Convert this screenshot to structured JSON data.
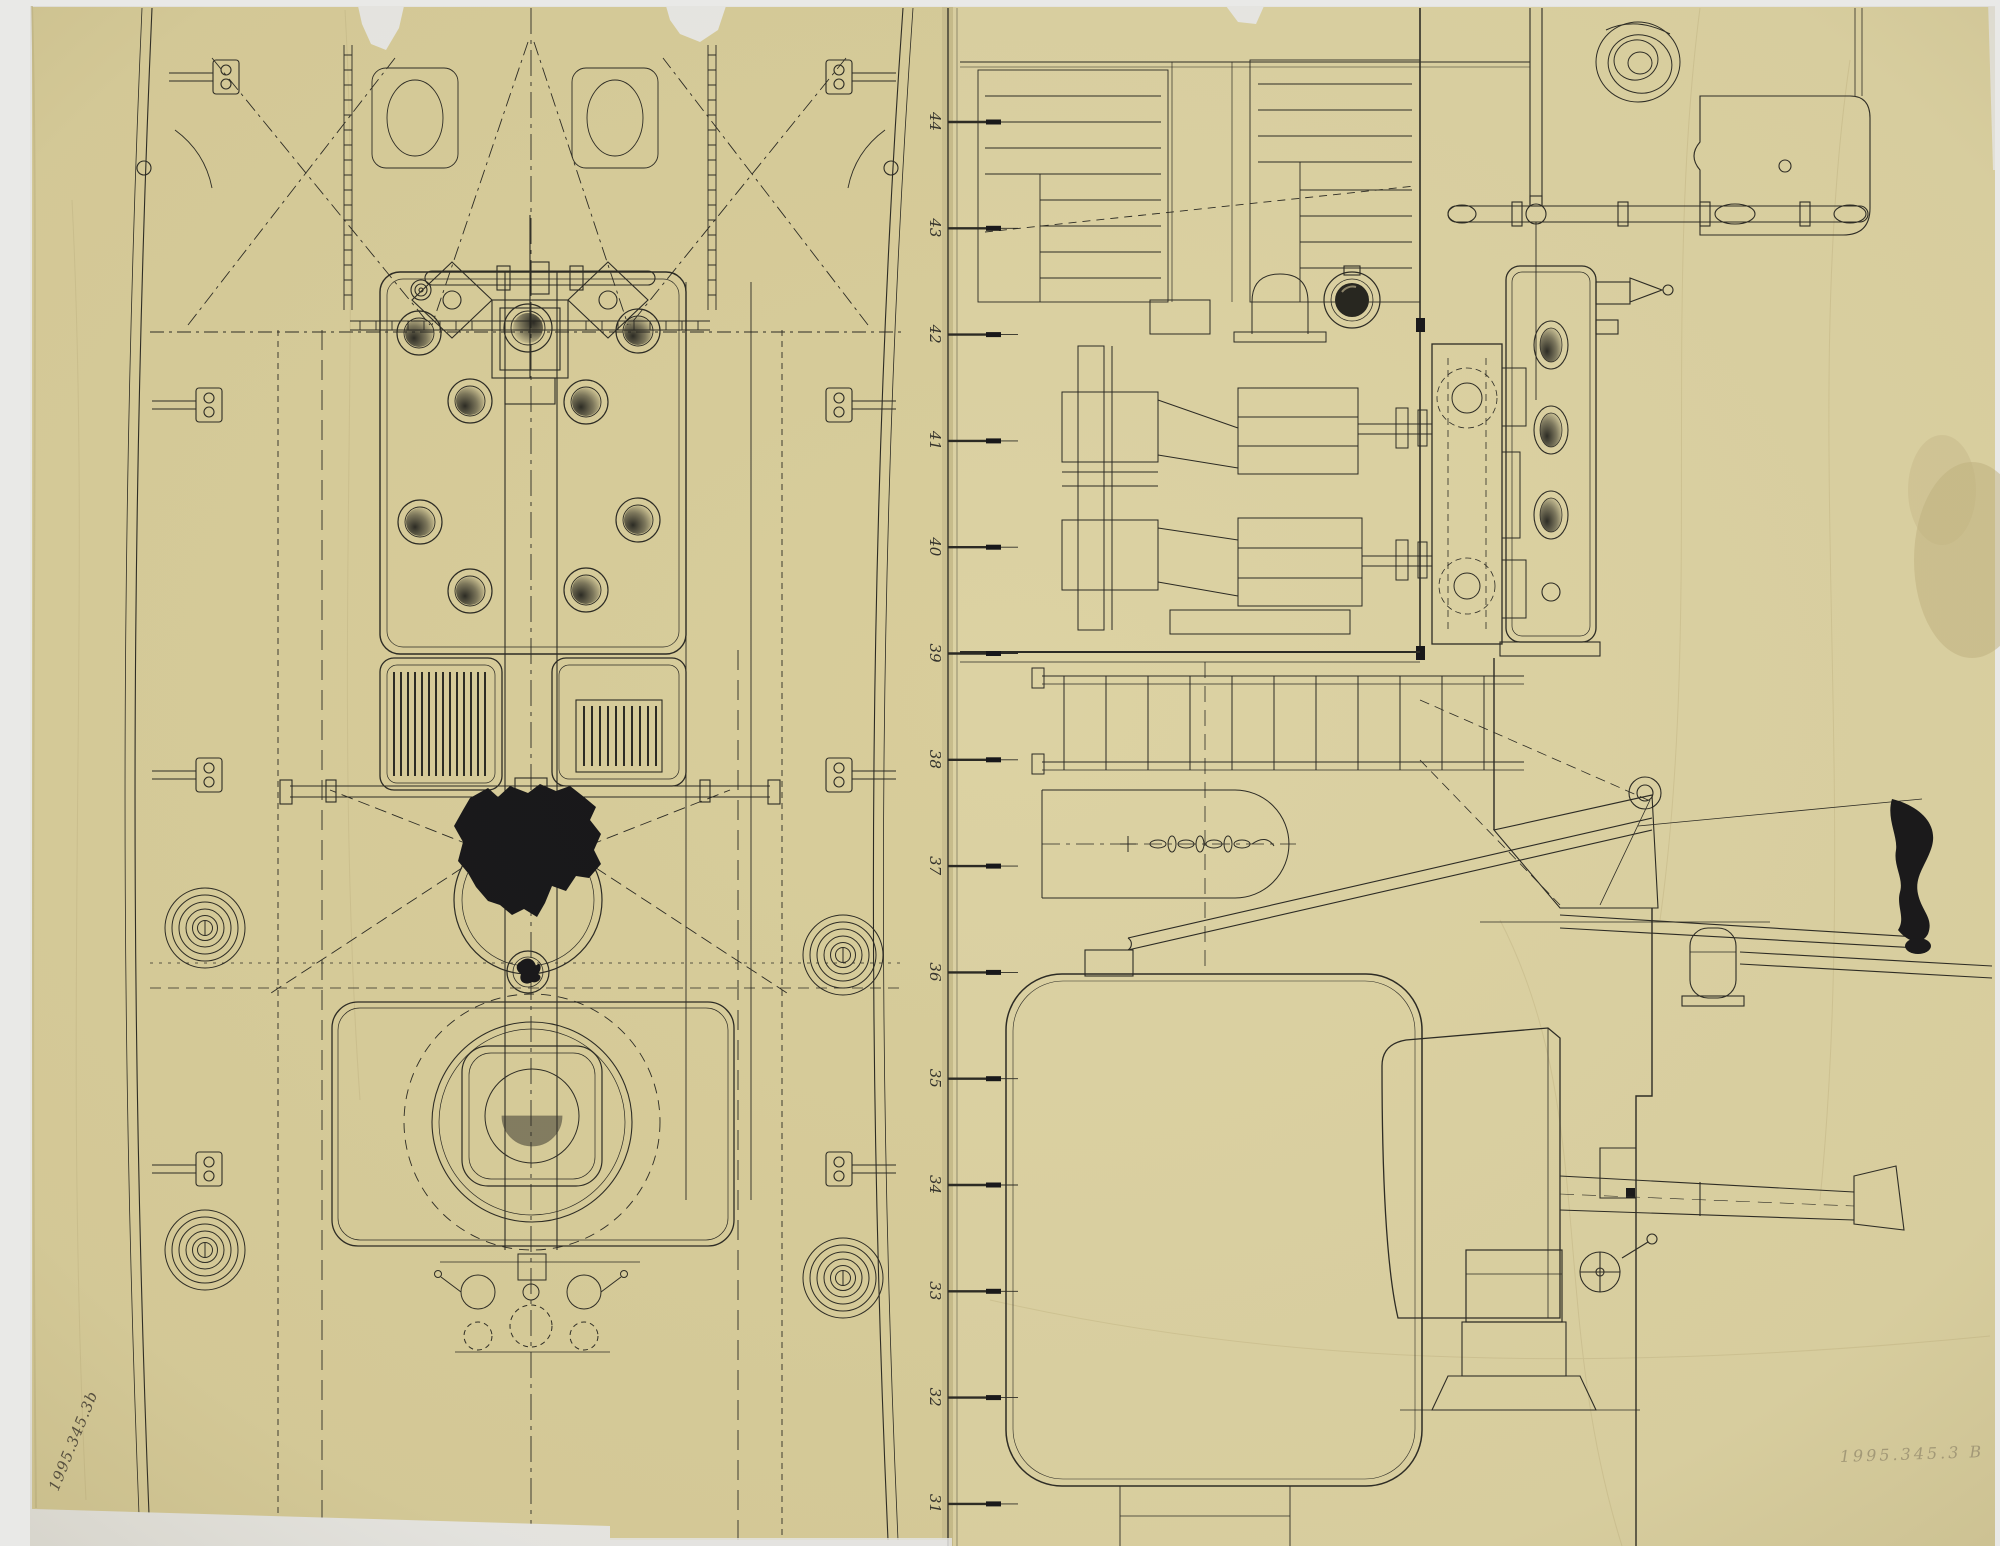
{
  "document": {
    "title": "Ship plan and profile technical drawing, two sheets of inked tracing paper",
    "backdrop_color": "#e9e9e7",
    "ink_color": "#2b2a24",
    "sheets": {
      "left": {
        "view": "deck plan, bow at top",
        "color": "#d8cd9b"
      },
      "right": {
        "view": "side elevation drawn rotated 90 degrees",
        "color": "#dcd2a3"
      }
    },
    "station_scale": {
      "orientation": "vertical line between sheets, labels rotated 90 degrees",
      "numbers": [
        "44",
        "43",
        "42",
        "41",
        "40",
        "39",
        "38",
        "37",
        "36",
        "35",
        "34",
        "33",
        "32",
        "31"
      ]
    },
    "features": {
      "deck_plan": [
        "bow rigging with anchor chains",
        "windlass with capstan bars",
        "twin bitts with oval chocks",
        "deckhouse with eight shaded portholes",
        "round centre hatch",
        "two grated skylights",
        "boat-skid beam",
        "black ink blot",
        "mast ring with stay lines",
        "gun platform turntable with round hatch",
        "hand winch with crank handles",
        "four flemish rope coils",
        "hull bulwark cleats"
      ],
      "profile": [
        "two companion stairways",
        "capstan with bars and rope coil",
        "dark porthole",
        "twin-cylinder steam engine",
        "ventilator dome",
        "deck tower with oval ports",
        "companion ladder",
        "stowed chain",
        "horizontal drum",
        "diagonal boom with davit bracket",
        "ensign staff with black flag",
        "mooring bitt",
        "large boiler casing",
        "deck gun with shield, barrel, handwheel and pedestal"
      ]
    },
    "annotations": {
      "accession_number_bottom_left": "1995.345.3b",
      "accession_number_bottom_right": "1995.345.3 B"
    }
  }
}
